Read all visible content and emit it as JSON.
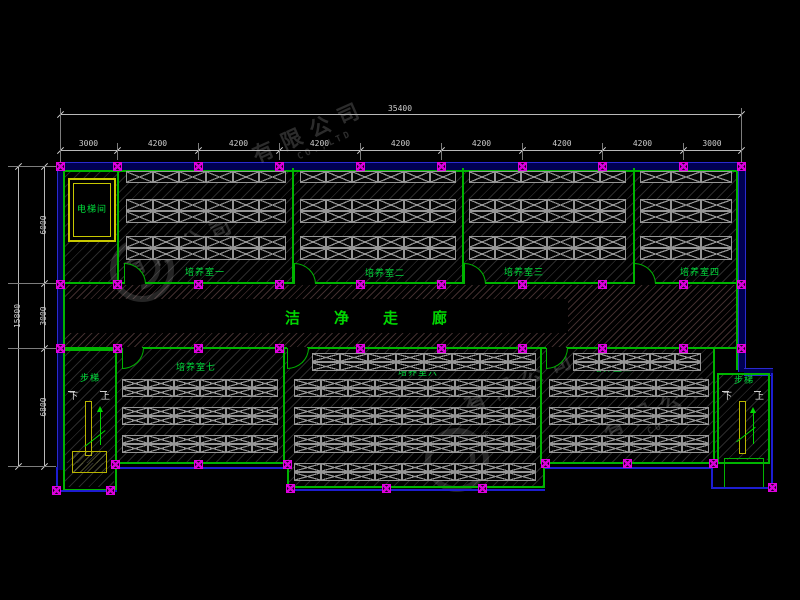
{
  "drawing": {
    "corridor_label": "洁净走廊",
    "elevator_label": "电梯间",
    "stair_label": "步梯",
    "stair_down": "下",
    "stair_up": "上",
    "rooms": [
      {
        "label": "培养室一"
      },
      {
        "label": "培养室二"
      },
      {
        "label": "培养室三"
      },
      {
        "label": "培养室四"
      },
      {
        "label": "培养室五"
      },
      {
        "label": "培养室六"
      },
      {
        "label": "培养室七"
      }
    ]
  },
  "dimensions": {
    "top_total": "35400",
    "top_segments": [
      "3000",
      "4200",
      "4200",
      "4200",
      "4200",
      "4200",
      "4200",
      "4200",
      "3000"
    ],
    "left_total": "15800",
    "left_segments": [
      "6000",
      "3000",
      "6800"
    ]
  },
  "watermark": {
    "company_fragment": "有限公司",
    "latin_fragment": "CO.,LTD",
    "registered_mark": "®"
  },
  "colors": {
    "wall_green": "#00b400",
    "outline_blue": "#1d1dd0",
    "column_marker_magenta": "#e000e0",
    "label_green": "#00e03c",
    "stair_yellow": "#b8b400",
    "rack_gray": "#969696",
    "dimension_gray": "#cdcdcd"
  }
}
